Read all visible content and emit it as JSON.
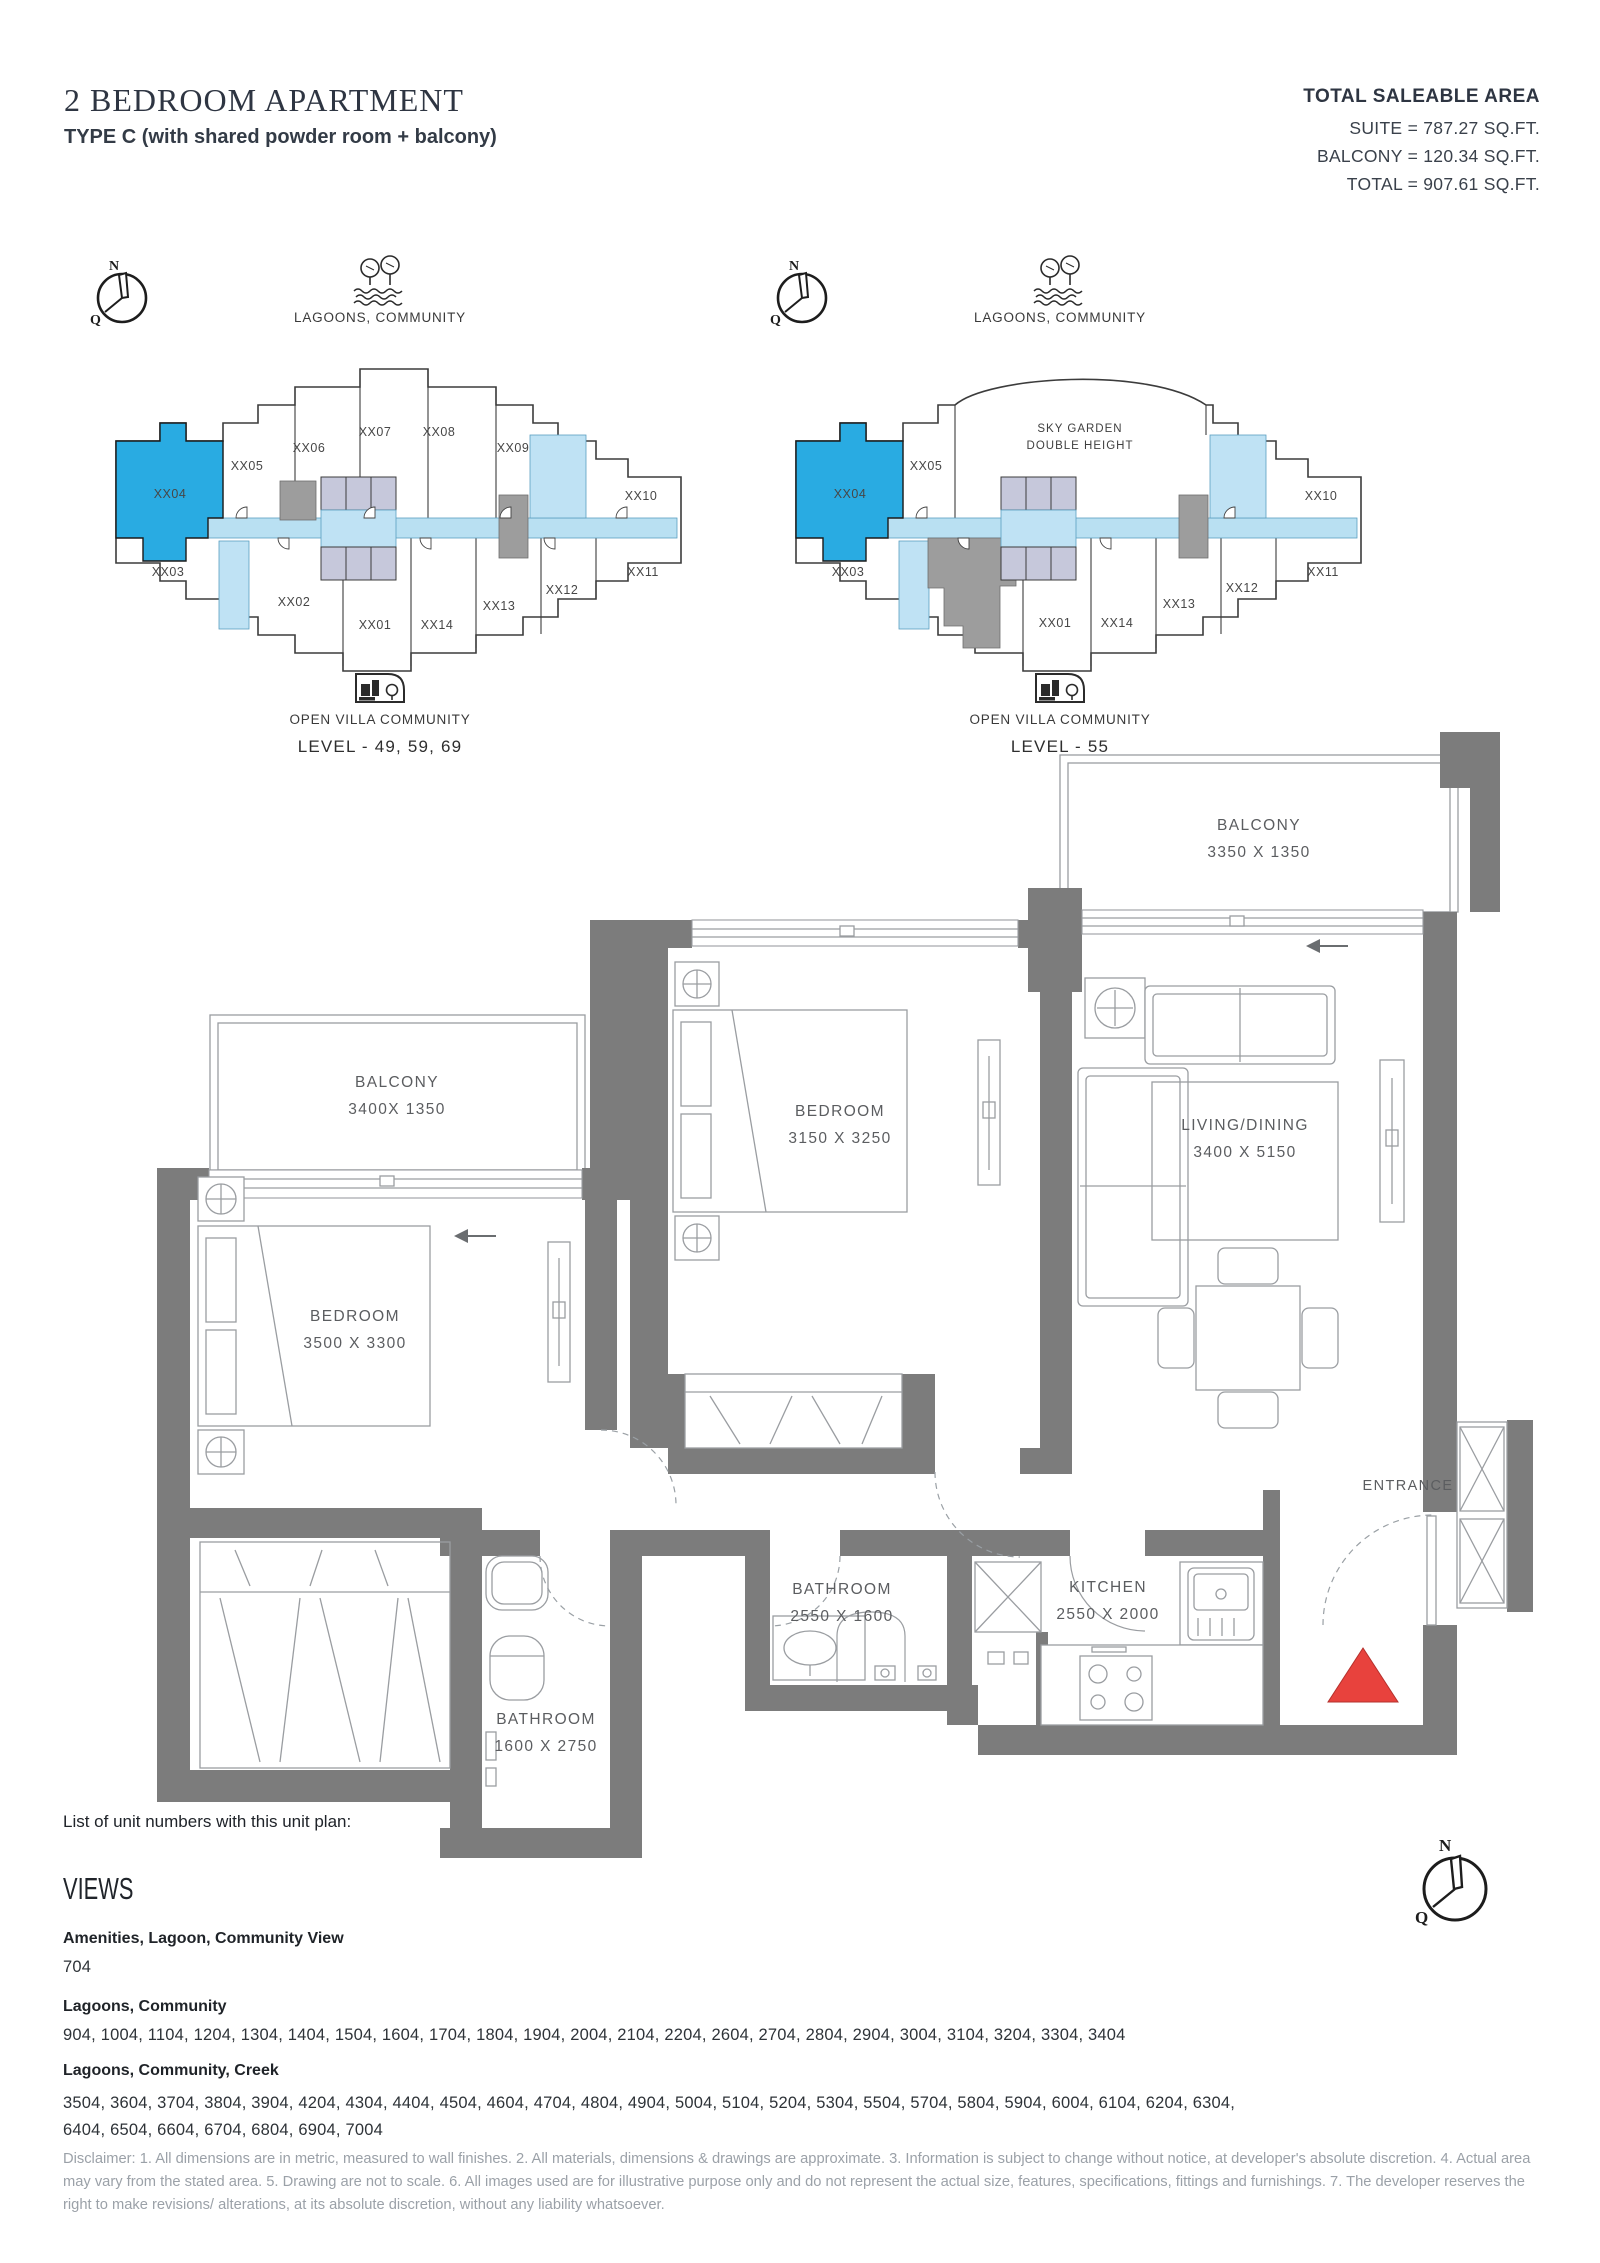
{
  "header": {
    "title": "2 BEDROOM APARTMENT",
    "subtitle": "TYPE C (with shared powder room + balcony)"
  },
  "area_summary": {
    "heading": "TOTAL SALEABLE AREA",
    "suite": "SUITE = 787.27 SQ.FT.",
    "balcony": "BALCONY = 120.34 SQ.FT.",
    "total": "TOTAL = 907.61 SQ.FT."
  },
  "compass": {
    "n": "N",
    "q": "Q"
  },
  "key_plans": [
    {
      "top_label": "LAGOONS, COMMUNITY",
      "bottom_label": "OPEN VILLA COMMUNITY",
      "level_label": "LEVEL - 49, 59, 69",
      "highlighted_unit": "XX04",
      "units": [
        "XX04",
        "XX05",
        "XX06",
        "XX07",
        "XX08",
        "XX09",
        "XX10",
        "XX03",
        "XX02",
        "XX01",
        "XX14",
        "XX13",
        "XX12",
        "XX11"
      ]
    },
    {
      "top_label": "LAGOONS, COMMUNITY",
      "bottom_label": "OPEN VILLA COMMUNITY",
      "level_label": "LEVEL - 55",
      "highlighted_unit": "XX04",
      "units": [
        "XX04",
        "XX05",
        "XX10",
        "XX03",
        "XX01",
        "XX14",
        "XX13",
        "XX12",
        "XX11"
      ],
      "center_area": [
        "SKY GARDEN",
        "DOUBLE HEIGHT"
      ]
    }
  ],
  "floor_plan": {
    "rooms": [
      {
        "name": "BALCONY",
        "dims": "3350 X 1350"
      },
      {
        "name": "BALCONY",
        "dims": "3400X 1350"
      },
      {
        "name": "BEDROOM",
        "dims": "3150 X 3250"
      },
      {
        "name": "BEDROOM",
        "dims": "3500 X 3300"
      },
      {
        "name": "LIVING/DINING",
        "dims": "3400 X 5150"
      },
      {
        "name": "BATHROOM",
        "dims": "2550 X 1600"
      },
      {
        "name": "BATHROOM",
        "dims": "1600 X 2750"
      },
      {
        "name": "KITCHEN",
        "dims": "2550 X 2000"
      }
    ],
    "entrance_label": "ENTRANCE"
  },
  "unit_list": {
    "intro": "List of unit numbers with this unit plan:",
    "views_heading": "VIEWS",
    "groups": [
      {
        "view": "Amenities, Lagoon, Community View",
        "units": "704"
      },
      {
        "view": "Lagoons, Community",
        "units": "904, 1004, 1104, 1204, 1304, 1404, 1504, 1604, 1704, 1804, 1904, 2004, 2104, 2204, 2604, 2704, 2804, 2904, 3004, 3104, 3204, 3304, 3404"
      },
      {
        "view": "Lagoons, Community, Creek",
        "units": "3504, 3604, 3704, 3804, 3904, 4204, 4304, 4404, 4504, 4604, 4704, 4804, 4904, 5004, 5104, 5204, 5304, 5504, 5704, 5804, 5904, 6004, 6104, 6204, 6304, 6404, 6504, 6604, 6704, 6804, 6904, 7004"
      }
    ]
  },
  "disclaimer": "Disclaimer: 1. All dimensions are in metric, measured to wall finishes. 2. All materials, dimensions & drawings are approximate. 3. Information is subject to change without notice, at developer's absolute discretion. 4. Actual area may vary from the stated area. 5. Drawing are not to scale. 6. All images used are for illustrative purpose only and do not represent the actual size, features, specifications, fittings and furnishings. 7. The developer reserves the right to make revisions/ alterations, at its absolute discretion, without any liability whatsoever.",
  "colors": {
    "highlight": "#29abe2",
    "corridor": "#b9e0f2",
    "core": "#c6c8db",
    "gray_block": "#9d9d9d",
    "wall": "#7c7c7c",
    "entrance_marker": "#e8423d"
  }
}
